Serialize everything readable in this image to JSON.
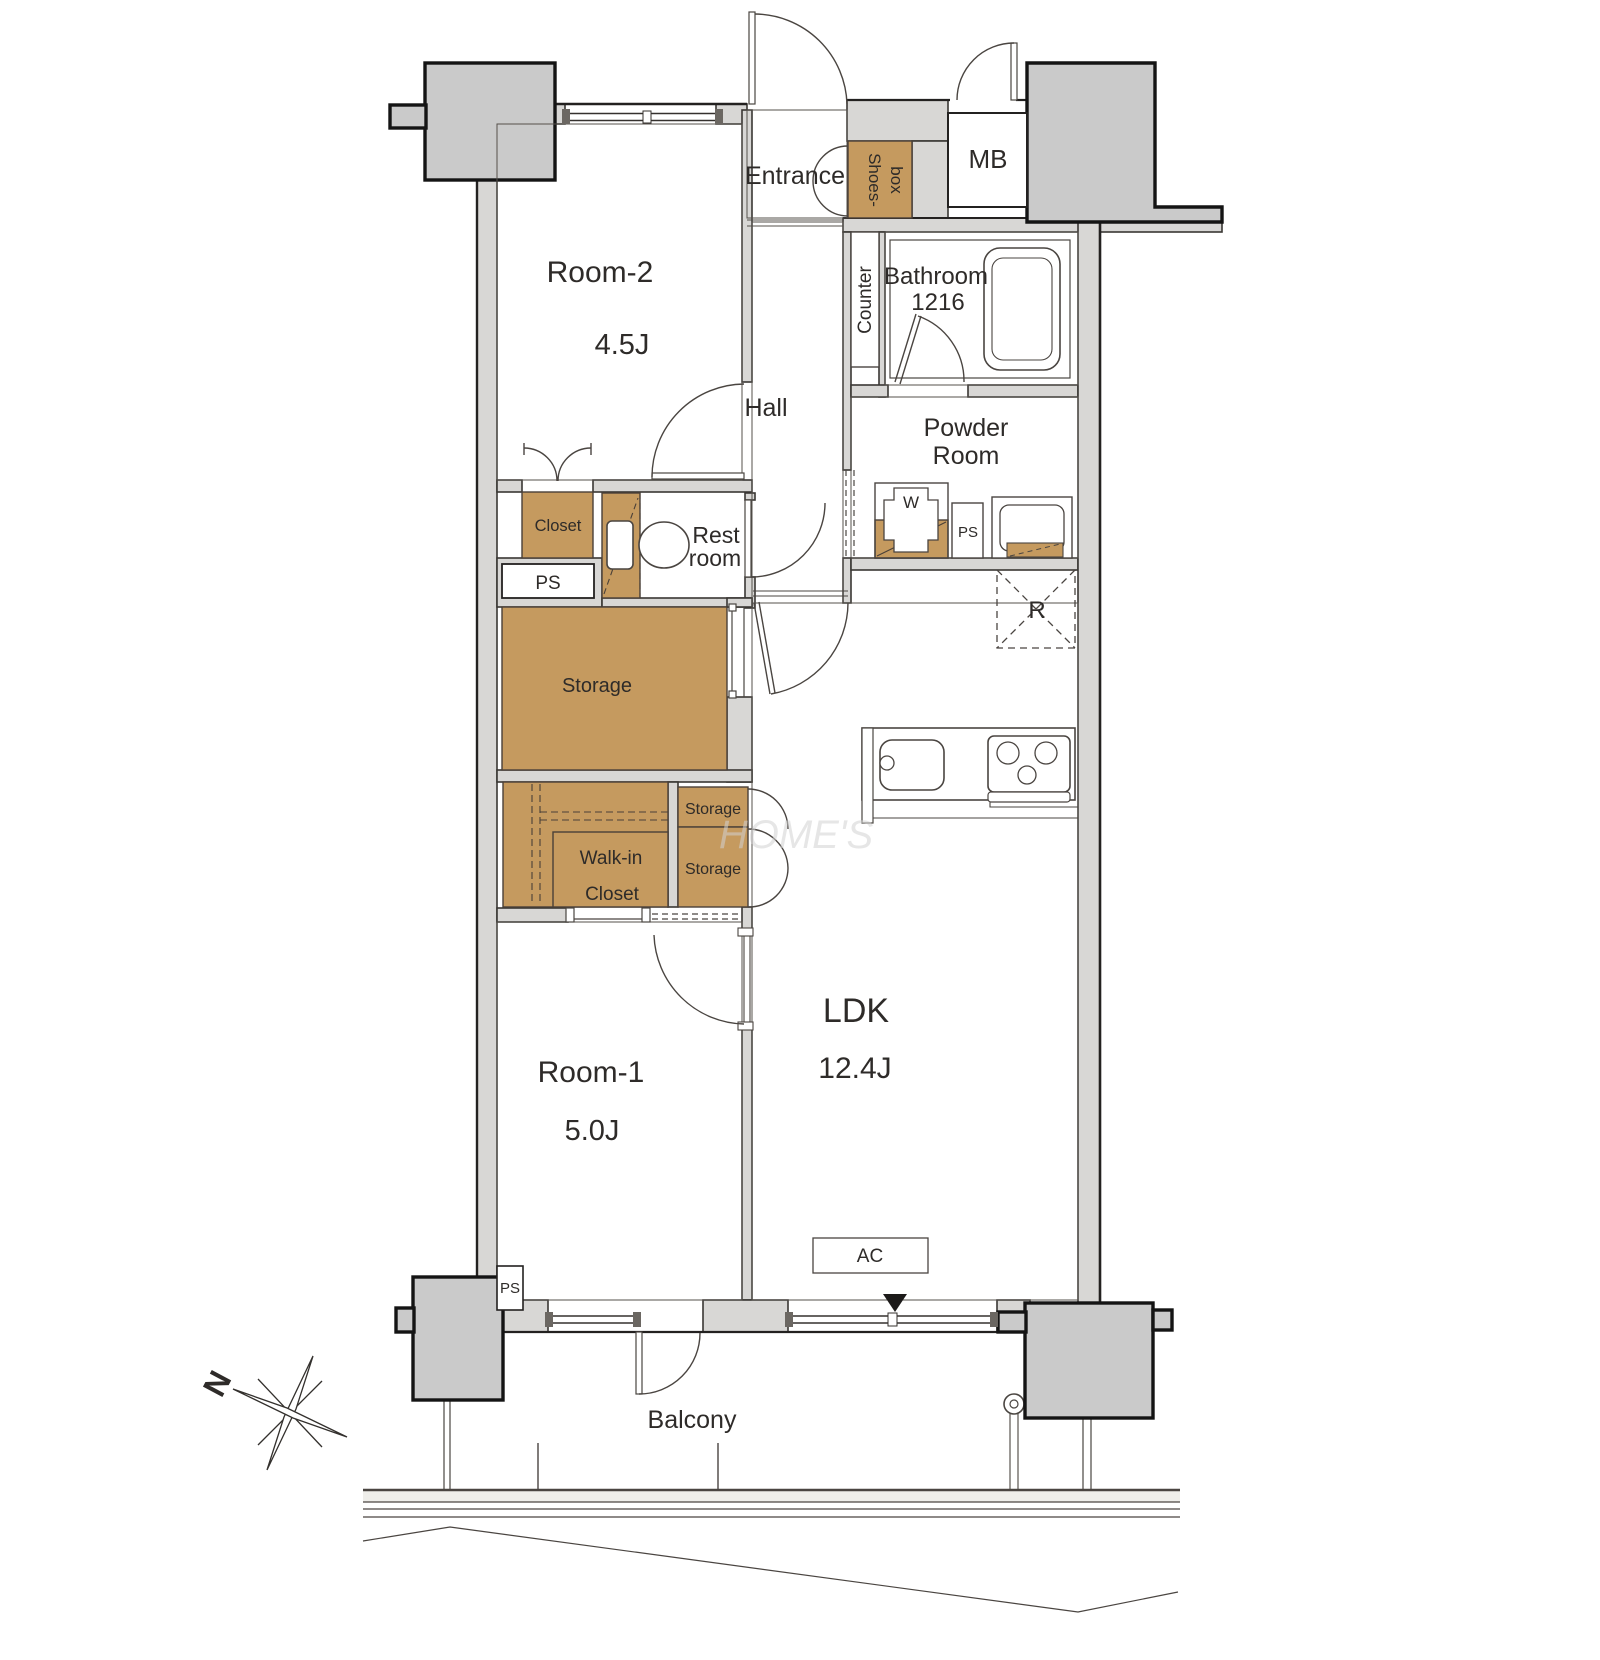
{
  "meta": {
    "type": "apartment-floor-plan",
    "style": "Japanese real-estate madori drawing"
  },
  "colors": {
    "furniture_tan": "#C59A5F",
    "wall_fill": "#D8D7D5",
    "pillar_fill": "#CACACA",
    "line_dark": "#2E2B29",
    "railing_band": "#EFEEEA"
  },
  "rooms": {
    "entrance": {
      "label": "Entrance"
    },
    "hall": {
      "label": "Hall"
    },
    "room2": {
      "label": "Room-2",
      "area": "4.5J"
    },
    "room1": {
      "label": "Room-1",
      "area": "5.0J"
    },
    "ldk": {
      "label": "LDK",
      "area": "12.4J"
    },
    "bathroom": {
      "label": "Bathroom",
      "size": "1216"
    },
    "powder_room": {
      "line1": "Powder",
      "line2": "Room"
    },
    "restroom": {
      "line1": "Rest",
      "line2": "room"
    },
    "balcony": {
      "label": "Balcony"
    }
  },
  "storage": {
    "shoes_box": {
      "line1": "Shoes-",
      "line2": "box"
    },
    "closet": {
      "label": "Closet"
    },
    "storage_main": {
      "label": "Storage"
    },
    "storage_upper": {
      "label": "Storage"
    },
    "storage_lower": {
      "label": "Storage"
    },
    "walk_in_closet": {
      "line1": "Walk-in",
      "line2": "Closet"
    }
  },
  "fixtures": {
    "mb": {
      "label": "MB"
    },
    "counter": {
      "label": "Counter"
    },
    "washer": {
      "label": "W"
    },
    "refrigerator": {
      "label": "R"
    },
    "air_conditioner": {
      "label": "AC"
    },
    "ps_closet": {
      "label": "PS"
    },
    "ps_powder": {
      "label": "PS"
    },
    "ps_bottom": {
      "label": "PS"
    }
  },
  "compass": {
    "label": "N"
  },
  "watermark": {
    "text": "HOME'S"
  }
}
